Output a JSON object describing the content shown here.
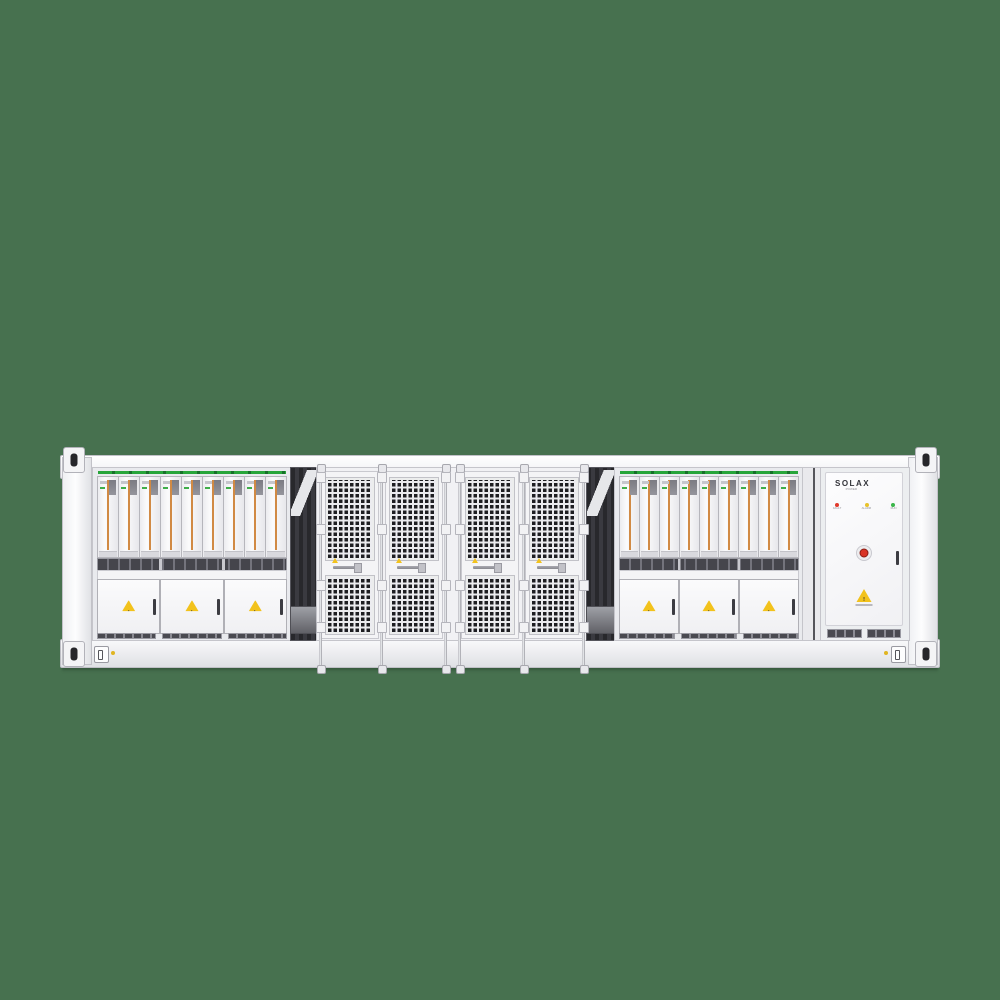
{
  "background_color": "#47714F",
  "container": {
    "pcs_cabinet_left": {
      "label": "PCS Distribution Cabinet",
      "module_count": 9,
      "door_count": 3,
      "warning_icon": "!"
    },
    "pcs_cabinet_right": {
      "label": "PCS Distribution Cabinet",
      "module_count": 9,
      "door_count": 3,
      "warning_icon": "!"
    },
    "battery_bay": {
      "mesh_door_count": 4
    },
    "control_cabinet": {
      "brand": "SOLAX",
      "brand_sub": "POWER",
      "indicators": [
        {
          "label": "FAULT",
          "color": "#E03A2C"
        },
        {
          "label": "ALARM",
          "color": "#E8C22A"
        },
        {
          "label": "RUN",
          "color": "#3AB54A"
        }
      ],
      "warning_icon": "!"
    },
    "colors": {
      "accent_orange": "#D18A44",
      "led_strip_green": "#27A53A",
      "warning_yellow": "#F2C21C",
      "frame_white": "#F4F4F6"
    }
  }
}
